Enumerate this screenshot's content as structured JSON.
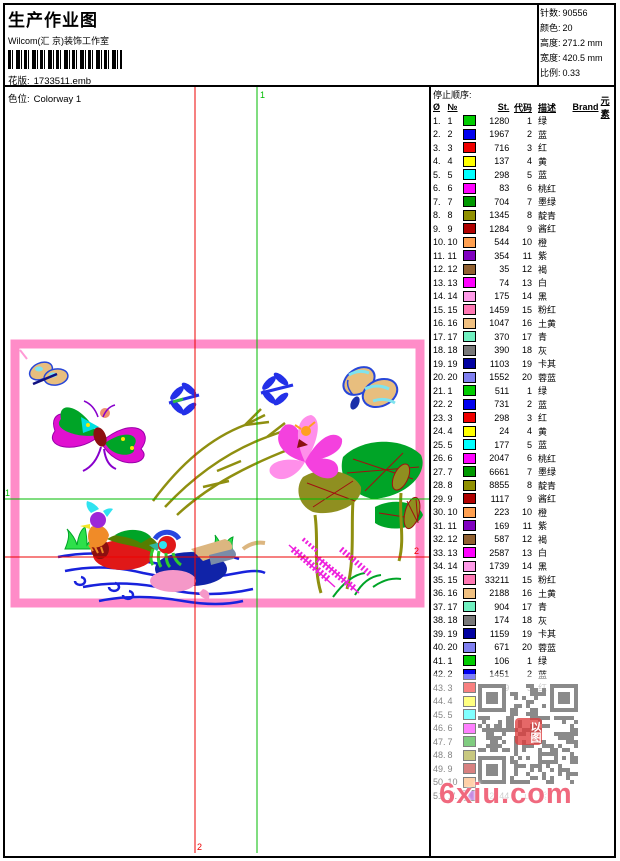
{
  "header": {
    "title": "生产作业图",
    "studio": "Wilcom(汇 京)装饰工作室",
    "pattern_label": "花版:",
    "pattern_value": "1733511.emb",
    "colorway_label": "色位:",
    "colorway_value": "Colorway 1"
  },
  "info": {
    "stitches_label": "针数:",
    "stitches": "90556",
    "colors_label": "颜色:",
    "colors": "20",
    "height_label": "高度:",
    "height": "271.2 mm",
    "width_label": "宽度:",
    "width": "420.5 mm",
    "scale_label": "比例:",
    "scale": "0.33"
  },
  "guides": {
    "v_green_label": "1",
    "v_red_label": "2",
    "h_green_label": "1",
    "h_red_label": "2",
    "green_color": "#00BB00",
    "red_color": "#EE0000"
  },
  "design": {
    "frame_pink": "#FF8CC8",
    "water_blue": "#1822DC",
    "leaf_green": "#00A427",
    "stem_olive": "#8F8F10",
    "lotus_pink": "#F441DE",
    "plant_magenta": "#EE22DD"
  },
  "table": {
    "title": "停止顺序:",
    "columns": [
      "Ø",
      "№",
      "St.",
      "代码",
      "描述",
      "Brand",
      "元素"
    ],
    "rows": [
      {
        "n": "1.",
        "no": "1",
        "color": "#00CC00",
        "st": "1280",
        "code": "1",
        "desc": "绿",
        "dim": false
      },
      {
        "n": "2.",
        "no": "2",
        "color": "#0000EE",
        "st": "1967",
        "code": "2",
        "desc": "蓝",
        "dim": false
      },
      {
        "n": "3.",
        "no": "3",
        "color": "#F00000",
        "st": "716",
        "code": "3",
        "desc": "红",
        "dim": false
      },
      {
        "n": "4.",
        "no": "4",
        "color": "#FFFF00",
        "st": "137",
        "code": "4",
        "desc": "黄",
        "dim": false
      },
      {
        "n": "5.",
        "no": "5",
        "color": "#00FFFF",
        "st": "298",
        "code": "5",
        "desc": "蓝",
        "dim": false
      },
      {
        "n": "6.",
        "no": "6",
        "color": "#FF00FF",
        "st": "83",
        "code": "6",
        "desc": "桃红",
        "dim": false
      },
      {
        "n": "7.",
        "no": "7",
        "color": "#009900",
        "st": "704",
        "code": "7",
        "desc": "墨绿",
        "dim": false
      },
      {
        "n": "8.",
        "no": "8",
        "color": "#909000",
        "st": "1345",
        "code": "8",
        "desc": "靛青",
        "dim": false
      },
      {
        "n": "9.",
        "no": "9",
        "color": "#B00000",
        "st": "1284",
        "code": "9",
        "desc": "酱红",
        "dim": false
      },
      {
        "n": "10.",
        "no": "10",
        "color": "#FFA050",
        "st": "544",
        "code": "10",
        "desc": "橙",
        "dim": false
      },
      {
        "n": "11.",
        "no": "11",
        "color": "#8000C0",
        "st": "354",
        "code": "11",
        "desc": "紫",
        "dim": false
      },
      {
        "n": "12.",
        "no": "12",
        "color": "#906030",
        "st": "35",
        "code": "12",
        "desc": "褐",
        "dim": false
      },
      {
        "n": "13.",
        "no": "13",
        "color": "#FF00FF",
        "st": "74",
        "code": "13",
        "desc": "白",
        "dim": false
      },
      {
        "n": "14.",
        "no": "14",
        "color": "#FF9BE8",
        "st": "175",
        "code": "14",
        "desc": "黑",
        "dim": false
      },
      {
        "n": "15.",
        "no": "15",
        "color": "#FF78B4",
        "st": "1459",
        "code": "15",
        "desc": "粉红",
        "dim": false
      },
      {
        "n": "16.",
        "no": "16",
        "color": "#F0C080",
        "st": "1047",
        "code": "16",
        "desc": "土黄",
        "dim": false
      },
      {
        "n": "17.",
        "no": "17",
        "color": "#70F0C0",
        "st": "370",
        "code": "17",
        "desc": "青",
        "dim": false
      },
      {
        "n": "18.",
        "no": "18",
        "color": "#787878",
        "st": "390",
        "code": "18",
        "desc": "灰",
        "dim": false
      },
      {
        "n": "19.",
        "no": "19",
        "color": "#0000A0",
        "st": "1103",
        "code": "19",
        "desc": "卡其",
        "dim": false
      },
      {
        "n": "20.",
        "no": "20",
        "color": "#8080F0",
        "st": "1552",
        "code": "20",
        "desc": "蓉蓝",
        "dim": false
      },
      {
        "n": "21.",
        "no": "1",
        "color": "#00CC00",
        "st": "511",
        "code": "1",
        "desc": "绿",
        "dim": false
      },
      {
        "n": "22.",
        "no": "2",
        "color": "#0000EE",
        "st": "731",
        "code": "2",
        "desc": "蓝",
        "dim": false
      },
      {
        "n": "23.",
        "no": "3",
        "color": "#F00000",
        "st": "298",
        "code": "3",
        "desc": "红",
        "dim": false
      },
      {
        "n": "24.",
        "no": "4",
        "color": "#FFFF00",
        "st": "24",
        "code": "4",
        "desc": "黄",
        "dim": false
      },
      {
        "n": "25.",
        "no": "5",
        "color": "#00FFFF",
        "st": "177",
        "code": "5",
        "desc": "蓝",
        "dim": false
      },
      {
        "n": "26.",
        "no": "6",
        "color": "#FF00FF",
        "st": "2047",
        "code": "6",
        "desc": "桃红",
        "dim": false
      },
      {
        "n": "27.",
        "no": "7",
        "color": "#009900",
        "st": "6661",
        "code": "7",
        "desc": "墨绿",
        "dim": false
      },
      {
        "n": "28.",
        "no": "8",
        "color": "#909000",
        "st": "8855",
        "code": "8",
        "desc": "靛青",
        "dim": false
      },
      {
        "n": "29.",
        "no": "9",
        "color": "#B00000",
        "st": "1117",
        "code": "9",
        "desc": "酱红",
        "dim": false
      },
      {
        "n": "30.",
        "no": "10",
        "color": "#FFA050",
        "st": "223",
        "code": "10",
        "desc": "橙",
        "dim": false
      },
      {
        "n": "31.",
        "no": "11",
        "color": "#8000C0",
        "st": "169",
        "code": "11",
        "desc": "紫",
        "dim": false
      },
      {
        "n": "32.",
        "no": "12",
        "color": "#906030",
        "st": "587",
        "code": "12",
        "desc": "褐",
        "dim": false
      },
      {
        "n": "33.",
        "no": "13",
        "color": "#FF00FF",
        "st": "2587",
        "code": "13",
        "desc": "白",
        "dim": false
      },
      {
        "n": "34.",
        "no": "14",
        "color": "#FF9BE8",
        "st": "1739",
        "code": "14",
        "desc": "黑",
        "dim": false
      },
      {
        "n": "35.",
        "no": "15",
        "color": "#FF78B4",
        "st": "33211",
        "code": "15",
        "desc": "粉红",
        "dim": false
      },
      {
        "n": "36.",
        "no": "16",
        "color": "#F0C080",
        "st": "2188",
        "code": "16",
        "desc": "土黄",
        "dim": false
      },
      {
        "n": "37.",
        "no": "17",
        "color": "#70F0C0",
        "st": "904",
        "code": "17",
        "desc": "青",
        "dim": false
      },
      {
        "n": "38.",
        "no": "18",
        "color": "#787878",
        "st": "174",
        "code": "18",
        "desc": "灰",
        "dim": false
      },
      {
        "n": "39.",
        "no": "19",
        "color": "#0000A0",
        "st": "1159",
        "code": "19",
        "desc": "卡其",
        "dim": false
      },
      {
        "n": "40.",
        "no": "20",
        "color": "#8080F0",
        "st": "671",
        "code": "20",
        "desc": "蓉蓝",
        "dim": false
      },
      {
        "n": "41.",
        "no": "1",
        "color": "#00CC00",
        "st": "106",
        "code": "1",
        "desc": "绿",
        "dim": false
      },
      {
        "n": "42.",
        "no": "2",
        "color": "#0000EE",
        "st": "1451",
        "code": "2",
        "desc": "蓝",
        "dim": false
      },
      {
        "n": "43.",
        "no": "3",
        "color": "#F00000",
        "st": "129",
        "code": "3",
        "desc": "红",
        "dim": true
      },
      {
        "n": "44.",
        "no": "4",
        "color": "#FFFF00",
        "st": "",
        "code": "",
        "desc": "",
        "dim": true
      },
      {
        "n": "45.",
        "no": "5",
        "color": "#00FFFF",
        "st": "",
        "code": "",
        "desc": "",
        "dim": true
      },
      {
        "n": "46.",
        "no": "6",
        "color": "#FF00FF",
        "st": "",
        "code": "",
        "desc": "",
        "dim": true
      },
      {
        "n": "47.",
        "no": "7",
        "color": "#009900",
        "st": "",
        "code": "",
        "desc": "",
        "dim": true
      },
      {
        "n": "48.",
        "no": "8",
        "color": "#909000",
        "st": "",
        "code": "",
        "desc": "",
        "dim": true
      },
      {
        "n": "49.",
        "no": "9",
        "color": "#B00000",
        "st": "",
        "code": "",
        "desc": "",
        "dim": true
      },
      {
        "n": "50.",
        "no": "10",
        "color": "#FFA050",
        "st": "",
        "code": "",
        "desc": "",
        "dim": true
      },
      {
        "n": "51.",
        "no": "11",
        "color": "#8000C0",
        "st": "2544",
        "code": "11",
        "desc": "紫",
        "dim": true
      }
    ]
  },
  "overlay": {
    "watermark": "6xiu.com",
    "stamp_text": "以图"
  }
}
